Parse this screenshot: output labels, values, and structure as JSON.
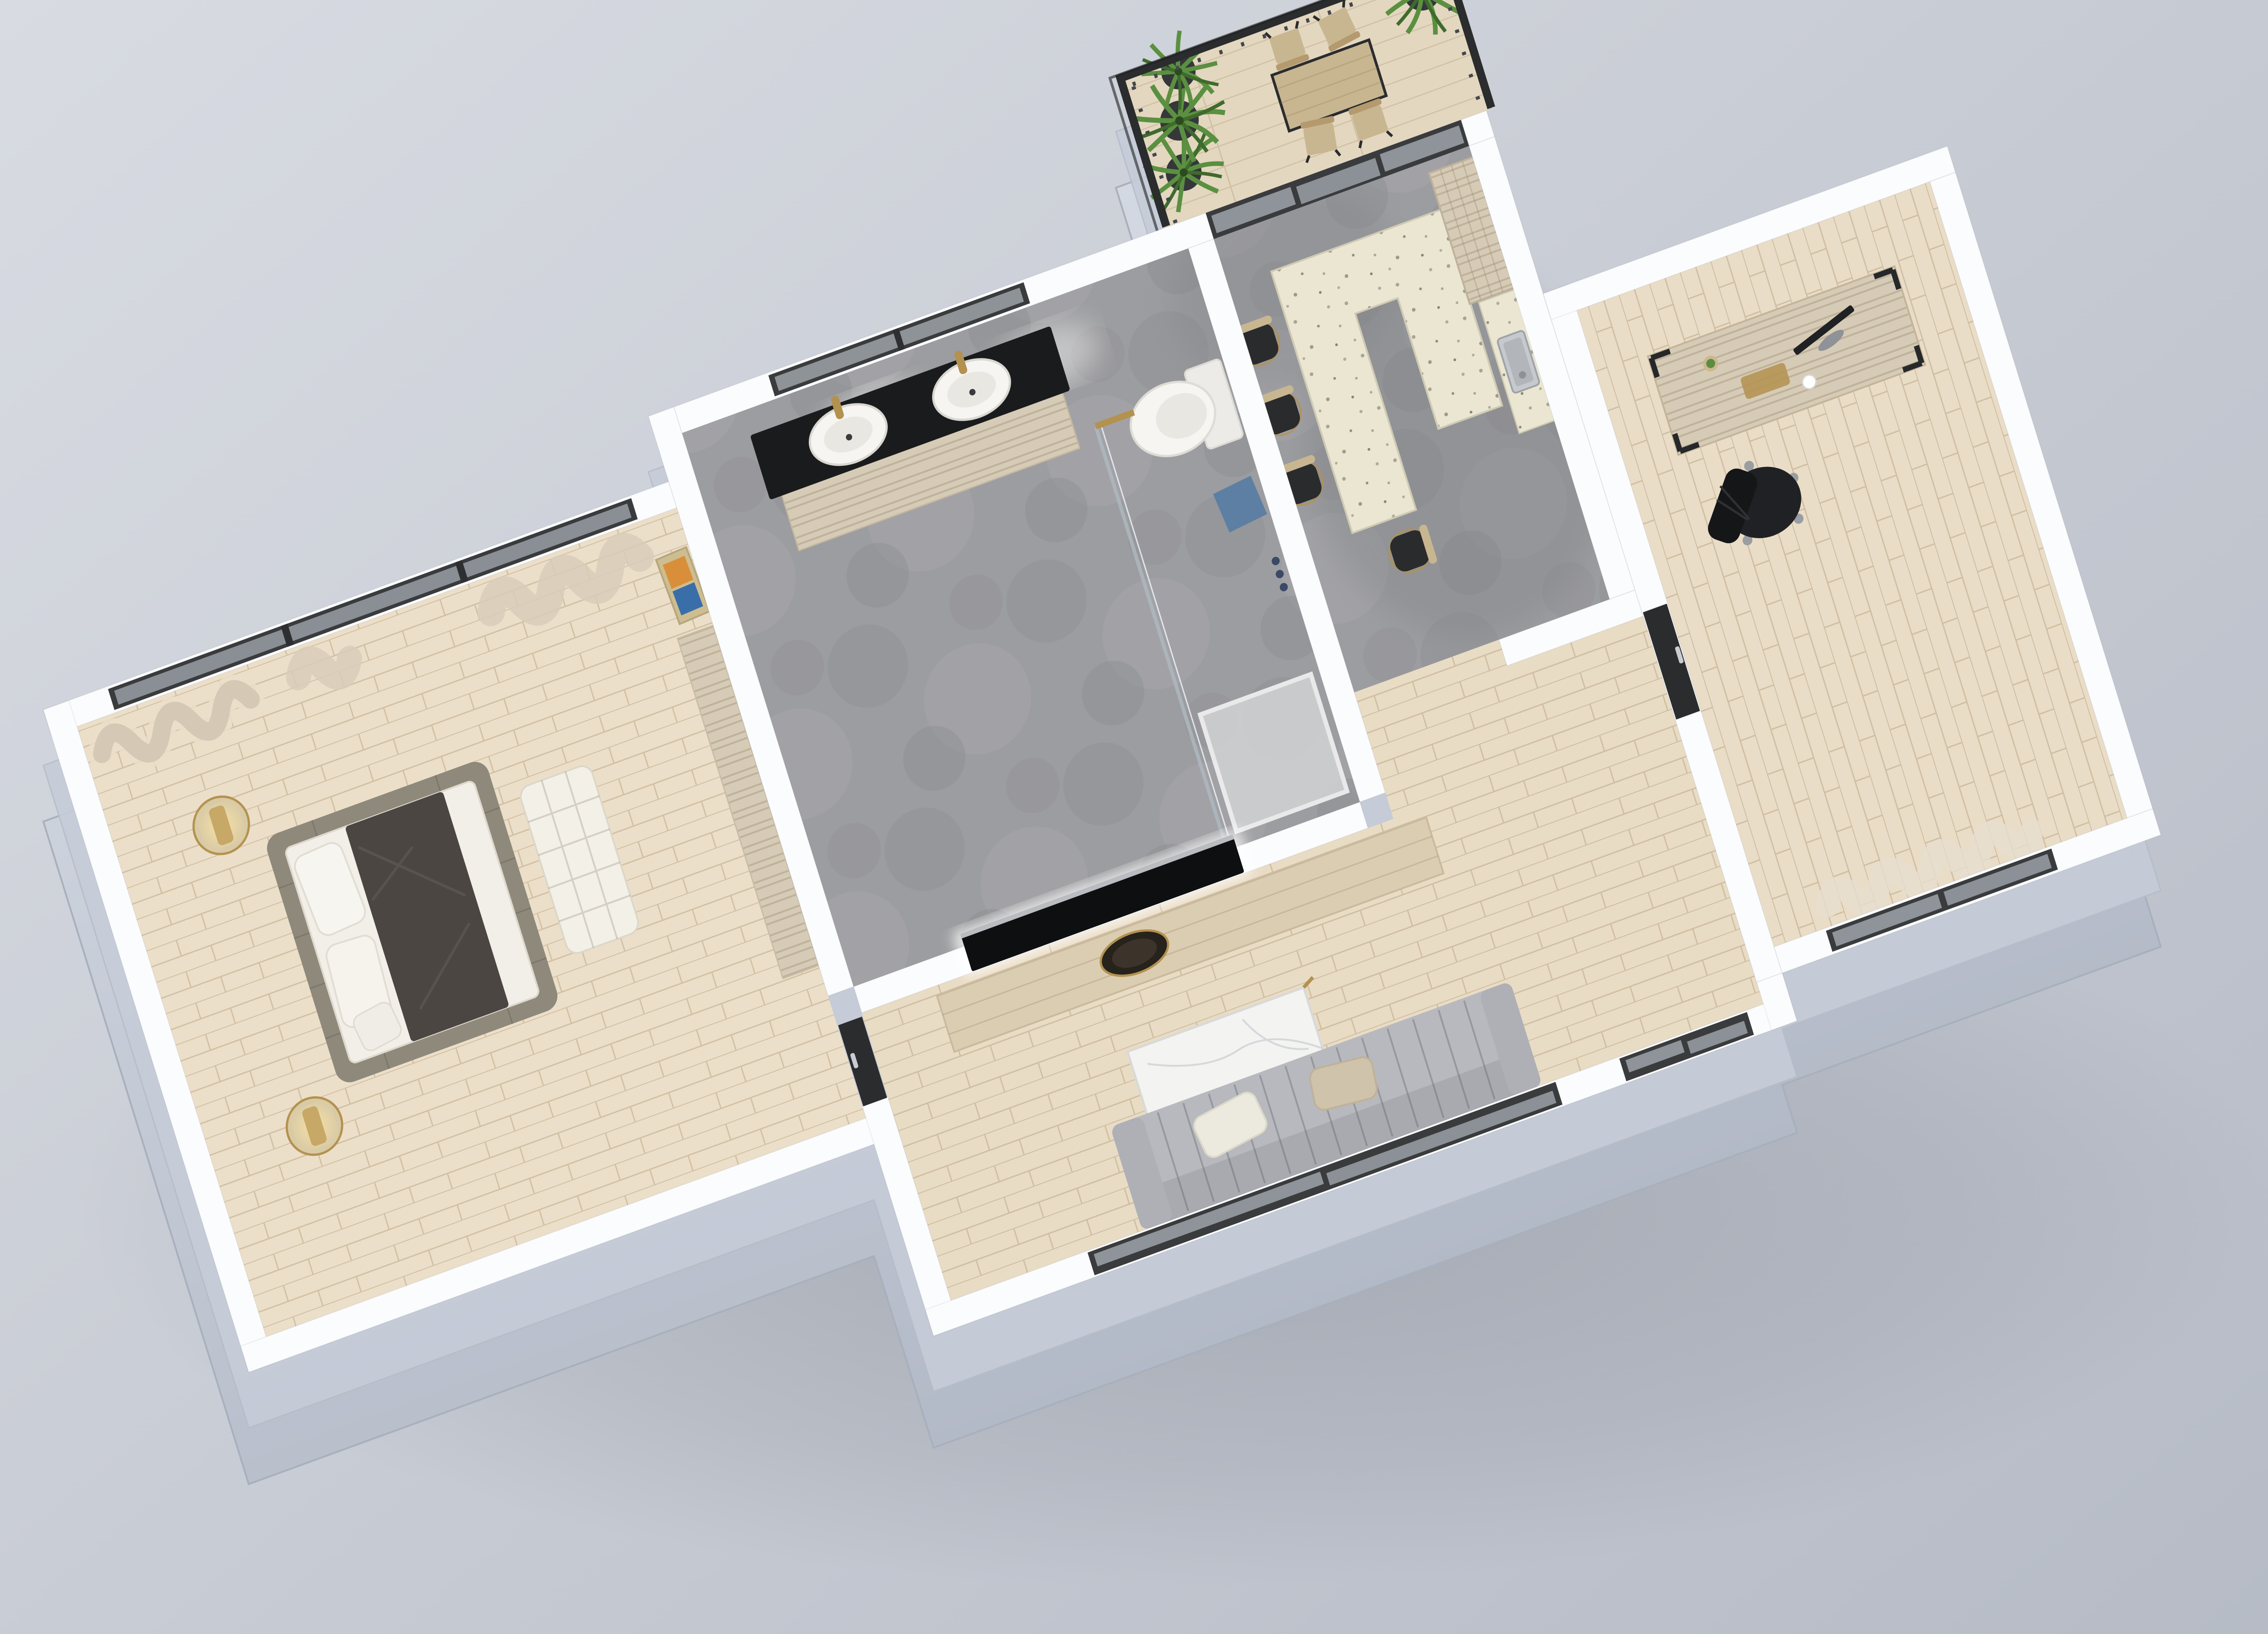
{
  "scene": {
    "type": "3d-floor-plan-render",
    "description": "Axonometric 3D render of a one-bedroom apartment with terrace",
    "rooms": [
      {
        "name": "bedroom",
        "floor": "light-wood",
        "furniture": [
          "platform-bed",
          "pillows",
          "dark-throw",
          "woven-bench",
          "side-table-lamp-north",
          "side-table-lamp-south",
          "low-wood-bench",
          "leaning-artwork",
          "sheer-curtains",
          "panoramic-window"
        ]
      },
      {
        "name": "bathroom",
        "floor": "concrete",
        "furniture": [
          "double-vanity",
          "vessel-sink-left",
          "vessel-sink-right",
          "gold-faucets",
          "slot-window",
          "wall-hung-toilet",
          "glass-shower-screen",
          "shower-tray",
          "blue-towel"
        ]
      },
      {
        "name": "kitchen",
        "floor": "concrete",
        "furniture": [
          "u-shaped-island",
          "terrazzo-countertop",
          "bar-stools",
          "steel-sink",
          "tall-wood-cabinet",
          "sliding-glass-wall"
        ]
      },
      {
        "name": "living-room",
        "floor": "light-wood",
        "furniture": [
          "tv-wall",
          "wall-tv",
          "media-console",
          "decor-bowl",
          "marble-coffee-table",
          "gray-sofa",
          "sliding-glass-door",
          "bedroom-door"
        ]
      },
      {
        "name": "hallway",
        "floor": "light-wood",
        "furniture": [
          "entry-glass-door",
          "office-door"
        ]
      },
      {
        "name": "office",
        "floor": "light-wood",
        "furniture": [
          "wood-desk",
          "monitor",
          "gold-keyboard",
          "mouse",
          "cactus",
          "task-chair",
          "front-window",
          "sheer-curtains"
        ]
      },
      {
        "name": "balcony",
        "floor": "deck-wood",
        "furniture": [
          "metal-railing",
          "potted-palms",
          "bistro-table",
          "wood-chairs"
        ]
      }
    ]
  },
  "palette": {
    "bg1": "#d8dbe2",
    "bg2": "#b6bbc6",
    "wall": "#fbfcfd",
    "wallFace": "#c6ccd8",
    "wallFaceDark": "#aeb5c2",
    "woodBed": "#ecdfc9",
    "woodLiving": "#e9dcc5",
    "woodOffice": "#eaddc7",
    "deck": "#e3d7c0",
    "concrete": "#9c9da0",
    "concreteDark": "#7f8184",
    "terrazzo": "#eae6d2",
    "counterBase": "#f7f7f8",
    "travertine": "#d6cbb6",
    "vanityTop": "#1a1b1d",
    "glass": "#ccd6e0",
    "frameDark": "#3a3b3d",
    "doorBlack": "#2b2c2e",
    "gold": "#b3924f",
    "bedBase": "#8f897b",
    "mattress": "#f2efe9",
    "throw": "#4b4642",
    "pillow": "#f7f5f0",
    "benchWhite": "#f3f0e8",
    "sofa": "#b8b9be",
    "sofaDark": "#a8aab0",
    "cushionTan": "#cfc3ab",
    "marble": "#f3f3f1",
    "railing": "#2a2c2e",
    "plant": "#5a9040",
    "plantDark": "#3f6b2c",
    "steel": "#c6c9cd",
    "steelDark": "#b2b6bb",
    "blueMat": "#5d7fa3",
    "chairBlack": "#202124",
    "stoolSeat": "#2a2b2d",
    "stoolWood": "#c8b691",
    "consoleWood": "#dbcdb2",
    "artOrange": "#d98f3a",
    "artBlue": "#3a6ea8",
    "lampGlow": "#ecd9a6",
    "toiletWhite": "#f6f5f2",
    "shadow": "#6a7078"
  }
}
